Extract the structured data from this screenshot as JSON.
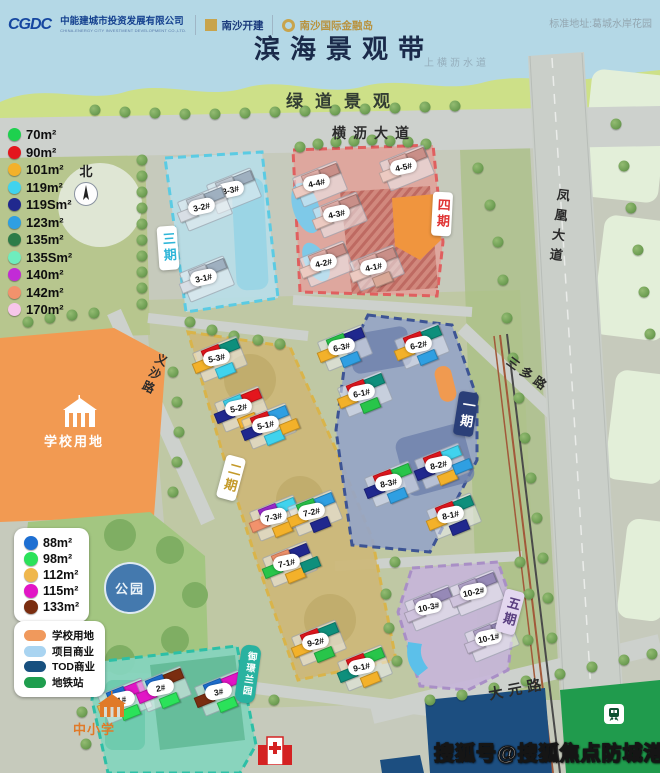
{
  "header": {
    "logo_cgdc_mark": "CGDC",
    "company1": "中能建城市投资发展有限公司",
    "company1_sub": "CHINA-ENERGY CITY INVESTMENT DEVELOPMENT CO.,LTD.",
    "company2": "南沙开建",
    "company3": "南沙国际金融岛",
    "address": "标准地址:葛城水岸花园",
    "title": "滨海景观带",
    "waterway": "上横沥水道",
    "greenway": "绿道景观"
  },
  "compass": {
    "north": "北"
  },
  "roads": {
    "hengli": "横沥大道",
    "fenghuang": "凤凰大道",
    "yisha": "义沙路",
    "sanduo": "三多路",
    "dayuan": "大元路"
  },
  "areas": {
    "school_site": "学校用地",
    "park": "公园",
    "primary_school": "中小学"
  },
  "legend_unit_types": {
    "items": [
      {
        "label": "70m²",
        "color": "#1ed14e"
      },
      {
        "label": "90m²",
        "color": "#e4161d"
      },
      {
        "label": "101m²",
        "color": "#f3b12a"
      },
      {
        "label": "119m²",
        "color": "#40d3ee"
      },
      {
        "label": "119Sm²",
        "color": "#20288e"
      },
      {
        "label": "123m²",
        "color": "#2f9fe2"
      },
      {
        "label": "135m²",
        "color": "#2d7c48"
      },
      {
        "label": "135Sm²",
        "color": "#6fedbe"
      },
      {
        "label": "140m²",
        "color": "#c22bd6"
      },
      {
        "label": "142m²",
        "color": "#f2926c"
      },
      {
        "label": "170m²",
        "color": "#f7c6ea"
      }
    ]
  },
  "legend_existing_units": {
    "items": [
      {
        "label": "88m²",
        "color": "#1e6fd2"
      },
      {
        "label": "98m²",
        "color": "#2be25a"
      },
      {
        "label": "112m²",
        "color": "#efb74d"
      },
      {
        "label": "115m²",
        "color": "#e215c6"
      },
      {
        "label": "133m²",
        "color": "#7a2d10"
      }
    ]
  },
  "legend_land_use": {
    "items": [
      {
        "label": "学校用地",
        "color": "#f0995c"
      },
      {
        "label": "项目商业",
        "color": "#a9d4f1"
      },
      {
        "label": "TOD商业",
        "color": "#17507f"
      },
      {
        "label": "地铁站",
        "color": "#1f9e4e"
      }
    ]
  },
  "phases": [
    {
      "name": "三期",
      "buildings": [
        {
          "label": "3-3#",
          "x": 232,
          "y": 190,
          "blocks": [
            "#c3ccd6",
            "#9fb0c0",
            "#d8dee5"
          ]
        },
        {
          "label": "3-2#",
          "x": 203,
          "y": 207,
          "blocks": [
            "#c3ccd6",
            "#9fb0c0",
            "#d8dee5"
          ]
        },
        {
          "label": "3-1#",
          "x": 205,
          "y": 278,
          "blocks": [
            "#c3ccd6",
            "#9fb0c0",
            "#d8dee5"
          ]
        }
      ]
    },
    {
      "name": "四期",
      "buildings": [
        {
          "label": "4-5#",
          "x": 405,
          "y": 167,
          "blocks": [
            "#e2afa9",
            "#c98f88",
            "#eccac1"
          ]
        },
        {
          "label": "4-4#",
          "x": 318,
          "y": 183,
          "blocks": [
            "#e2afa9",
            "#c98f88",
            "#eccac1"
          ]
        },
        {
          "label": "4-3#",
          "x": 338,
          "y": 214,
          "blocks": [
            "#e2afa9",
            "#c98f88",
            "#eccac1"
          ]
        },
        {
          "label": "4-2#",
          "x": 325,
          "y": 263,
          "blocks": [
            "#e2afa9",
            "#c98f88",
            "#eccac1"
          ]
        },
        {
          "label": "4-1#",
          "x": 375,
          "y": 267,
          "blocks": [
            "#e2afa9",
            "#c98f88",
            "#eccac1",
            "#d9a897"
          ]
        }
      ]
    },
    {
      "name": "二期",
      "buildings": [
        {
          "label": "5-3#",
          "x": 218,
          "y": 358,
          "blocks": [
            "#e4161d",
            "#0e8f7c",
            "#f3b12a",
            "#40d3ee"
          ]
        },
        {
          "label": "5-2#",
          "x": 240,
          "y": 408,
          "blocks": [
            "#40d3ee",
            "#e4161d",
            "#20288e",
            "#f3b12a"
          ]
        },
        {
          "label": "5-1#",
          "x": 267,
          "y": 425,
          "blocks": [
            "#e4161d",
            "#2f9fe2",
            "#20288e",
            "#40d3ee",
            "#f3b12a"
          ]
        },
        {
          "label": "7-3#",
          "x": 275,
          "y": 517,
          "blocks": [
            "#9c2bd0",
            "#40d3ee",
            "#f2926c",
            "#f3b12a"
          ]
        },
        {
          "label": "7-2#",
          "x": 313,
          "y": 512,
          "blocks": [
            "#28c54a",
            "#2f9fe2",
            "#f3b12a",
            "#20288e"
          ]
        },
        {
          "label": "7-1#",
          "x": 288,
          "y": 563,
          "blocks": [
            "#f2926c",
            "#20288e",
            "#28c54a",
            "#f3b12a",
            "#0e8f7c"
          ]
        },
        {
          "label": "9-2#",
          "x": 317,
          "y": 642,
          "blocks": [
            "#e4161d",
            "#0e8f7c",
            "#f3b12a",
            "#28c54a"
          ]
        },
        {
          "label": "9-1#",
          "x": 363,
          "y": 667,
          "blocks": [
            "#e4161d",
            "#28c54a",
            "#0e8f7c",
            "#f3b12a"
          ]
        }
      ]
    },
    {
      "name": "一期",
      "buildings": [
        {
          "label": "6-3#",
          "x": 343,
          "y": 347,
          "blocks": [
            "#28c54a",
            "#20288e",
            "#f3b12a",
            "#2f9fe2"
          ]
        },
        {
          "label": "6-2#",
          "x": 420,
          "y": 345,
          "blocks": [
            "#e4161d",
            "#0e8f7c",
            "#f3b12a",
            "#2f9fe2"
          ]
        },
        {
          "label": "6-1#",
          "x": 363,
          "y": 393,
          "blocks": [
            "#e4161d",
            "#0e8f7c",
            "#f3b12a",
            "#28c54a"
          ]
        },
        {
          "label": "8-3#",
          "x": 390,
          "y": 483,
          "blocks": [
            "#e4161d",
            "#28c54a",
            "#20288e",
            "#2f9fe2"
          ]
        },
        {
          "label": "8-2#",
          "x": 440,
          "y": 465,
          "blocks": [
            "#e4161d",
            "#40d3ee",
            "#20288e",
            "#f3b12a",
            "#2f9fe2"
          ]
        },
        {
          "label": "8-1#",
          "x": 452,
          "y": 515,
          "blocks": [
            "#e4161d",
            "#0e8f7c",
            "#f3b12a",
            "#20288e"
          ]
        }
      ]
    },
    {
      "name": "五期",
      "buildings": [
        {
          "label": "10-3#",
          "x": 430,
          "y": 607,
          "blocks": [
            "#b3a5cb",
            "#9689b7",
            "#cfc3dd"
          ]
        },
        {
          "label": "10-2#",
          "x": 475,
          "y": 592,
          "blocks": [
            "#b3a5cb",
            "#9689b7",
            "#cfc3dd"
          ]
        },
        {
          "label": "10-1#",
          "x": 490,
          "y": 638,
          "blocks": [
            "#b3a5cb",
            "#9689b7",
            "#cfc3dd"
          ]
        }
      ]
    },
    {
      "name": "御璟兰园",
      "buildings": [
        {
          "label": "1#",
          "x": 123,
          "y": 700,
          "blocks": [
            "#1e6fd2",
            "#e215c6",
            "#efb74d",
            "#2be25a"
          ]
        },
        {
          "label": "2#",
          "x": 162,
          "y": 688,
          "blocks": [
            "#1e6fd2",
            "#7a2d10",
            "#e215c6",
            "#2be25a"
          ]
        },
        {
          "label": "3#",
          "x": 220,
          "y": 692,
          "blocks": [
            "#1e6fd2",
            "#e215c6",
            "#7a2d10",
            "#2be25a"
          ]
        }
      ]
    }
  ],
  "watermark": "搜狐号@搜狐焦点防城港站"
}
